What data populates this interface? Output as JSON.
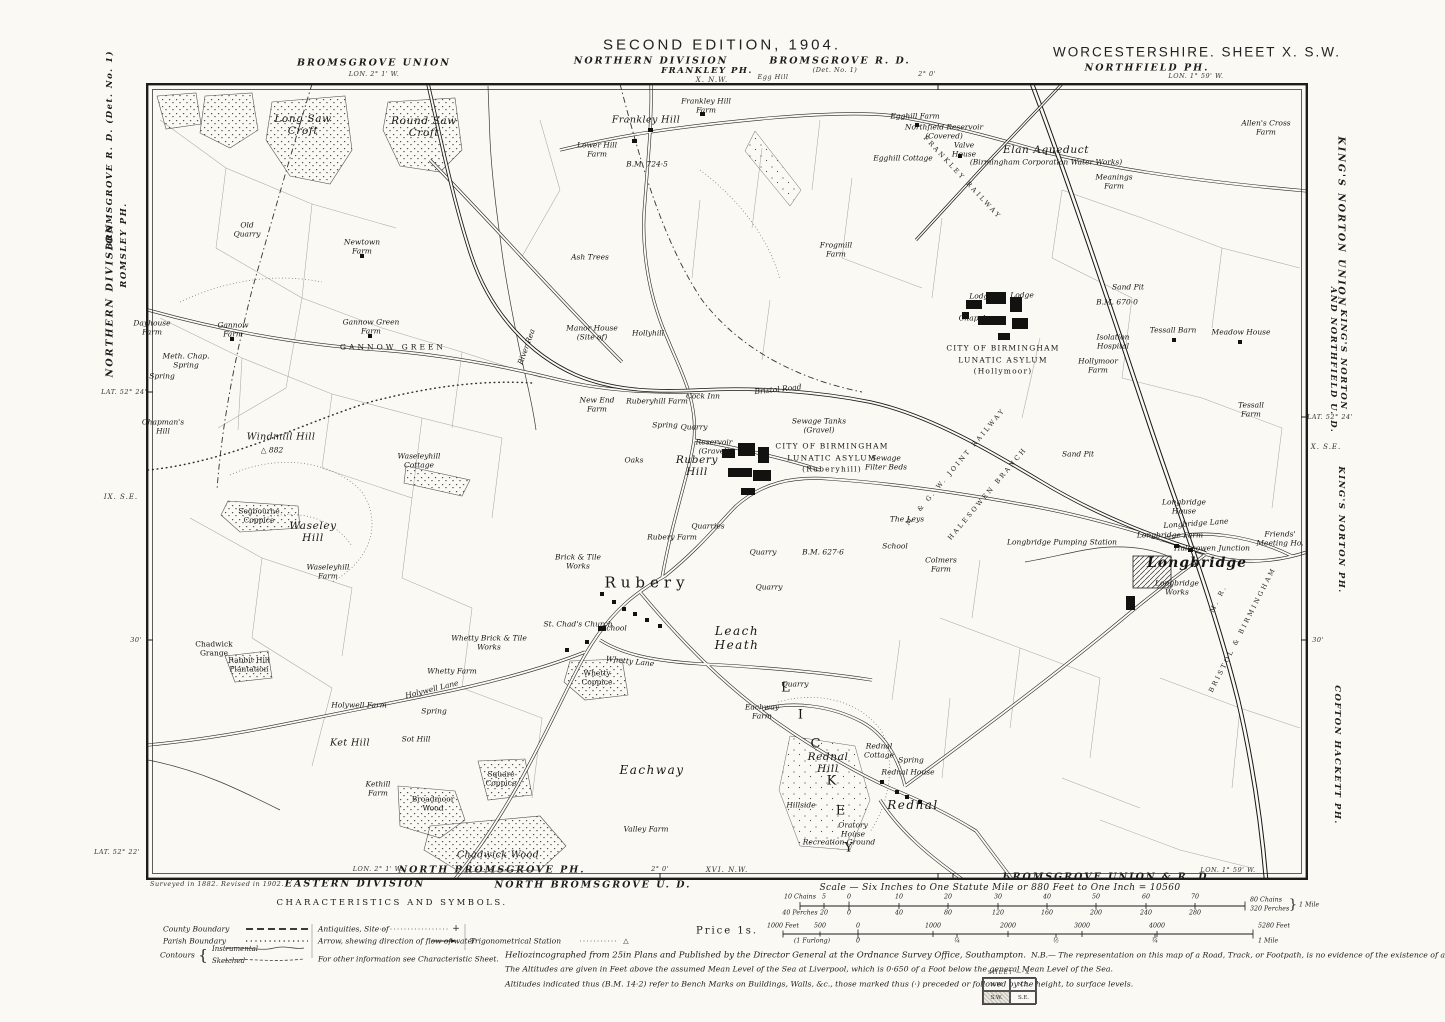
{
  "colors": {
    "paper": "#fbf9f4",
    "ink": "#1c1c1b",
    "field_lines": "#9a9a9a"
  },
  "header": {
    "union_left": "BROMSGROVE UNION",
    "lon_left": "LON. 2° 1' W.",
    "edition": "SECOND EDITION, 1904.",
    "division": "NORTHERN DIVISION",
    "frankley": "FRANKLEY PH.",
    "adjoining_top": "X. N.W.",
    "egg_hill": "Egg Hill",
    "bromsgrove_rd": "BROMSGROVE R. D.",
    "det": "(Det. No. 1)",
    "lon_tick": "2° 0'",
    "county_sheet": "WORCESTERSHIRE. SHEET X. S.W.",
    "northfield": "NORTHFIELD PH.",
    "lon_right": "LON. 1° 59' W."
  },
  "margin_left": {
    "division": "NORTHERN DIVISION",
    "romsley": "ROMSLEY PH.",
    "bromsgrove": "BROMSGROVE R. D.  (Det. No. 1)",
    "lat": "LAT. 52° 24'",
    "adjoining": "IX. S.E.",
    "tick30": "30'",
    "lat_bottom": "LAT. 52° 22'"
  },
  "margin_right": {
    "union": "KING'S NORTON UNION",
    "und": "KING'S NORTON\nAND NORTHFIELD U. D.",
    "lat": "LAT. 52° 24'",
    "adjoining": "X. S.E.",
    "tick30": "30'",
    "kings_norton_ph": "KING'S NORTON PH.",
    "cofton": "COFTON HACKETT PH."
  },
  "margin_bottom": {
    "surveyed": "Surveyed in 1882.   Revised in 1902.",
    "eastern_division": "EASTERN DIVISION",
    "lon_left": "LON. 2° 1' W.",
    "north_bromsgrove_ph": "NORTH BROMSGROVE PH.",
    "north_bromsgrove_ud": "NORTH BROMSGROVE U. D.",
    "lon_tick": "2° 0'",
    "adjoining": "XVI. N.W.",
    "bromsgrove_union_rd": "BROMSGROVE UNION & R. D.",
    "lon_right": "LON. 1° 59' W."
  },
  "legend": {
    "title": "CHARACTERISTICS AND SYMBOLS.",
    "county": "County Boundary",
    "parish": "Parish Boundary",
    "contours": "Contours",
    "brace": "{",
    "instrumental": "Instrumental",
    "sketched": "Sketched",
    "antiquities": "Antiquities, Site of",
    "antiquities_sym": "+",
    "arrow": "Arrow, shewing direction of flow of water",
    "trig": "Trigonometrical Station",
    "trig_sym": "△",
    "other_info": "For other information see Characteristic Sheet."
  },
  "scale": {
    "caption": "Scale — Six Inches to One Statute Mile or 880 Feet to One Inch = 10560",
    "price": "Price  1s.",
    "end1_top": "80 Chains",
    "end1_bottom": "320 Perches",
    "brace1": "}",
    "end1_mile": "1 Mile",
    "end2_feet": "5280 Feet",
    "end2_mile": "1 Mile",
    "ticks": [
      {
        "t": "10 Chains",
        "x": 800,
        "y": 897
      },
      {
        "t": "5",
        "x": 824,
        "y": 897
      },
      {
        "t": "0",
        "x": 849,
        "y": 897
      },
      {
        "t": "10",
        "x": 899,
        "y": 897
      },
      {
        "t": "20",
        "x": 948,
        "y": 897
      },
      {
        "t": "30",
        "x": 998,
        "y": 897
      },
      {
        "t": "40",
        "x": 1047,
        "y": 897
      },
      {
        "t": "50",
        "x": 1096,
        "y": 897
      },
      {
        "t": "60",
        "x": 1146,
        "y": 897
      },
      {
        "t": "70",
        "x": 1195,
        "y": 897
      },
      {
        "t": "40 Perches",
        "x": 800,
        "y": 913
      },
      {
        "t": "20",
        "x": 824,
        "y": 913
      },
      {
        "t": "0",
        "x": 849,
        "y": 913
      },
      {
        "t": "40",
        "x": 899,
        "y": 913
      },
      {
        "t": "80",
        "x": 948,
        "y": 913
      },
      {
        "t": "120",
        "x": 998,
        "y": 913
      },
      {
        "t": "160",
        "x": 1047,
        "y": 913
      },
      {
        "t": "200",
        "x": 1096,
        "y": 913
      },
      {
        "t": "240",
        "x": 1146,
        "y": 913
      },
      {
        "t": "280",
        "x": 1195,
        "y": 913
      },
      {
        "t": "1000 Feet",
        "x": 783,
        "y": 926
      },
      {
        "t": "500",
        "x": 820,
        "y": 926
      },
      {
        "t": "0",
        "x": 858,
        "y": 926
      },
      {
        "t": "1000",
        "x": 933,
        "y": 926
      },
      {
        "t": "2000",
        "x": 1008,
        "y": 926
      },
      {
        "t": "3000",
        "x": 1082,
        "y": 926
      },
      {
        "t": "4000",
        "x": 1157,
        "y": 926
      },
      {
        "t": "(1 Furlong)",
        "x": 812,
        "y": 941
      },
      {
        "t": "0",
        "x": 858,
        "y": 941
      },
      {
        "t": "¼",
        "x": 957,
        "y": 941
      },
      {
        "t": "½",
        "x": 1056,
        "y": 941
      },
      {
        "t": "¾",
        "x": 1155,
        "y": 941
      }
    ]
  },
  "imprint": {
    "line1": "Heliozincographed from 25in Plans and Published by the Director General at the Ordnance Survey Office, Southampton.",
    "nb": "N.B.— The representation on this map of a Road, Track, or Footpath, is no evidence of the existence of a right of way.",
    "line2": "The Altitudes are given in Feet above the assumed Mean Level of the Sea at Liverpool, which is 0·650 of a Foot below the general Mean Level of the Sea.",
    "line3": "Altitudes indicated thus (B.M. 14·2) refer to Bench Marks on Buildings, Walls, &c., those marked thus (·) preceded or followed by the height, to surface levels."
  },
  "sheet_diagram": {
    "header": "SHEET — X",
    "nw": "N.W.",
    "ne": "N.E.",
    "sw": "S.W.",
    "se": "S.E."
  },
  "map_labels": [
    {
      "t": "Long Saw\nCroft",
      "x": 303,
      "y": 125,
      "c": "h"
    },
    {
      "t": "Round Saw\nCroft",
      "x": 424,
      "y": 127,
      "c": "h"
    },
    {
      "t": "Old\nQuarry",
      "x": 247,
      "y": 230,
      "c": "t"
    },
    {
      "t": "Newtown\nFarm",
      "x": 362,
      "y": 247,
      "c": "t"
    },
    {
      "t": "Ash Trees",
      "x": 590,
      "y": 258,
      "c": "t"
    },
    {
      "t": "B.M. 724·5",
      "x": 647,
      "y": 165,
      "c": "t"
    },
    {
      "t": "Frankley Hill",
      "x": 646,
      "y": 121,
      "c": "n"
    },
    {
      "t": "Frankley Hill\nFarm",
      "x": 706,
      "y": 106,
      "c": "t"
    },
    {
      "t": "Lower Hill\nFarm",
      "x": 597,
      "y": 150,
      "c": "t"
    },
    {
      "t": "Egghill Farm",
      "x": 915,
      "y": 117,
      "c": "t"
    },
    {
      "t": "Egghill Cottage",
      "x": 903,
      "y": 159,
      "c": "t"
    },
    {
      "t": "Northfield Reservoir\n(Covered)",
      "x": 944,
      "y": 132,
      "c": "t"
    },
    {
      "t": "Valve\nHouse",
      "x": 964,
      "y": 150,
      "c": "t"
    },
    {
      "t": "Elan Aqueduct",
      "x": 1046,
      "y": 150,
      "c": "h"
    },
    {
      "t": "(Birmingham Corporation Water Works)",
      "x": 1046,
      "y": 163,
      "c": "t"
    },
    {
      "t": "Frogmill\nFarm",
      "x": 836,
      "y": 250,
      "c": "t"
    },
    {
      "t": "Meanings\nFarm",
      "x": 1114,
      "y": 182,
      "c": "t"
    },
    {
      "t": "Allen's Cross\nFarm",
      "x": 1266,
      "y": 128,
      "c": "t"
    },
    {
      "t": "FRANKLEY RAILWAY",
      "x": 962,
      "y": 178,
      "c": "rly",
      "r": 47
    },
    {
      "t": "Sand Pit",
      "x": 1128,
      "y": 288,
      "c": "t"
    },
    {
      "t": "B.M. 670·0",
      "x": 1117,
      "y": 303,
      "c": "t"
    },
    {
      "t": "Lodge",
      "x": 981,
      "y": 297,
      "c": "t"
    },
    {
      "t": "Lodge",
      "x": 1022,
      "y": 296,
      "c": "t"
    },
    {
      "t": "Chapel",
      "x": 972,
      "y": 319,
      "c": "t"
    },
    {
      "t": "CITY OF BIRMINGHAM\nLUNATIC ASYLUM\n(Hollymoor)",
      "x": 1003,
      "y": 360,
      "c": "asy"
    },
    {
      "t": "Isolation\nHospital",
      "x": 1113,
      "y": 342,
      "c": "t"
    },
    {
      "t": "Hollymoor\nFarm",
      "x": 1098,
      "y": 366,
      "c": "t"
    },
    {
      "t": "Tessall Barn",
      "x": 1173,
      "y": 331,
      "c": "t"
    },
    {
      "t": "Meadow House",
      "x": 1241,
      "y": 333,
      "c": "t"
    },
    {
      "t": "Tessall\nFarm",
      "x": 1251,
      "y": 410,
      "c": "t"
    },
    {
      "t": "Sand Pit",
      "x": 1078,
      "y": 455,
      "c": "t"
    },
    {
      "t": "Dayhouse\nFarm",
      "x": 152,
      "y": 328,
      "c": "t"
    },
    {
      "t": "Meth. Chap.\nSpring",
      "x": 186,
      "y": 361,
      "c": "t"
    },
    {
      "t": "Spring",
      "x": 162,
      "y": 377,
      "c": "t"
    },
    {
      "t": "Gannow\nFarm",
      "x": 233,
      "y": 330,
      "c": "t"
    },
    {
      "t": "Gannow Green\nFarm",
      "x": 371,
      "y": 327,
      "c": "t"
    },
    {
      "t": "GANNOW GREEN",
      "x": 393,
      "y": 348,
      "c": "cap"
    },
    {
      "t": "Chapman's\nHill",
      "x": 163,
      "y": 427,
      "c": "t"
    },
    {
      "t": "Windmill Hill",
      "x": 281,
      "y": 438,
      "c": "n"
    },
    {
      "t": "△ 882",
      "x": 272,
      "y": 451,
      "c": "t"
    },
    {
      "t": "Waseleyhill\nCottage",
      "x": 419,
      "y": 461,
      "c": "t"
    },
    {
      "t": "Segbourne\nCoppice",
      "x": 259,
      "y": 516,
      "c": "tr"
    },
    {
      "t": "Waseley\nHill",
      "x": 313,
      "y": 532,
      "c": "h"
    },
    {
      "t": "Waseleyhill\nFarm",
      "x": 328,
      "y": 572,
      "c": "t"
    },
    {
      "t": "River Rea",
      "x": 527,
      "y": 347,
      "c": "t",
      "r": -70
    },
    {
      "t": "Manor House\n(Site of)",
      "x": 592,
      "y": 333,
      "c": "t"
    },
    {
      "t": "Hollyhill",
      "x": 648,
      "y": 334,
      "c": "t"
    },
    {
      "t": "New End\nFarm",
      "x": 597,
      "y": 405,
      "c": "t"
    },
    {
      "t": "Ruberyhill Farm",
      "x": 657,
      "y": 402,
      "c": "t"
    },
    {
      "t": "Cock Inn",
      "x": 703,
      "y": 397,
      "c": "t"
    },
    {
      "t": "Spring",
      "x": 665,
      "y": 426,
      "c": "t"
    },
    {
      "t": "Quarry",
      "x": 694,
      "y": 428,
      "c": "t"
    },
    {
      "t": "Reservoir\n(Gravel)",
      "x": 714,
      "y": 447,
      "c": "t"
    },
    {
      "t": "Rubery\nHill",
      "x": 697,
      "y": 466,
      "c": "h"
    },
    {
      "t": "Oaks",
      "x": 634,
      "y": 461,
      "c": "t"
    },
    {
      "t": "Sewage Tanks\n(Gravel)",
      "x": 819,
      "y": 426,
      "c": "t"
    },
    {
      "t": "CITY OF BIRMINGHAM\nLUNATIC ASYLUM\n(Ruberyhill)",
      "x": 832,
      "y": 458,
      "c": "asy"
    },
    {
      "t": "Sewage\nFilter Beds",
      "x": 886,
      "y": 463,
      "c": "t"
    },
    {
      "t": "Bristol Road",
      "x": 778,
      "y": 390,
      "c": "t",
      "r": -6
    },
    {
      "t": "M. & G. W. JOINT RAILWAY",
      "x": 956,
      "y": 467,
      "c": "rly",
      "r": -50
    },
    {
      "t": "HALESOWEN BRANCH",
      "x": 988,
      "y": 494,
      "c": "rly",
      "r": -50
    },
    {
      "t": "Quarries",
      "x": 708,
      "y": 527,
      "c": "t"
    },
    {
      "t": "Rubery Farm",
      "x": 672,
      "y": 538,
      "c": "t"
    },
    {
      "t": "Quarry",
      "x": 763,
      "y": 553,
      "c": "t"
    },
    {
      "t": "Quarry",
      "x": 769,
      "y": 588,
      "c": "t"
    },
    {
      "t": "B.M. 627·6",
      "x": 823,
      "y": 553,
      "c": "t"
    },
    {
      "t": "Brick & Tile\nWorks",
      "x": 578,
      "y": 562,
      "c": "t"
    },
    {
      "t": "Rubery",
      "x": 647,
      "y": 583,
      "c": "vil"
    },
    {
      "t": "St. Chad's Church",
      "x": 578,
      "y": 625,
      "c": "t"
    },
    {
      "t": "The Leys",
      "x": 907,
      "y": 520,
      "c": "t"
    },
    {
      "t": "School",
      "x": 895,
      "y": 547,
      "c": "t"
    },
    {
      "t": "Colmers\nFarm",
      "x": 941,
      "y": 565,
      "c": "t"
    },
    {
      "t": "Longbridge Pumping Station",
      "x": 1062,
      "y": 543,
      "c": "t"
    },
    {
      "t": "Halesowen Junction",
      "x": 1212,
      "y": 549,
      "c": "t"
    },
    {
      "t": "Longbridge\nHouse",
      "x": 1184,
      "y": 507,
      "c": "t"
    },
    {
      "t": "Longbridge Lane",
      "x": 1196,
      "y": 524,
      "c": "t",
      "r": -4
    },
    {
      "t": "Longbridge Farm",
      "x": 1170,
      "y": 536,
      "c": "t"
    },
    {
      "t": "Longbridge",
      "x": 1197,
      "y": 563,
      "c": "vb"
    },
    {
      "t": "Longbridge\nWorks",
      "x": 1177,
      "y": 588,
      "c": "t"
    },
    {
      "t": "Friends'\nMeeting Ho.",
      "x": 1280,
      "y": 539,
      "c": "t"
    },
    {
      "t": "M. R.",
      "x": 1219,
      "y": 599,
      "c": "rly",
      "r": -63
    },
    {
      "t": "BRISTOL & BIRMINGHAM",
      "x": 1243,
      "y": 630,
      "c": "rly",
      "r": -63
    },
    {
      "t": "Whetty Brick & Tile\nWorks",
      "x": 489,
      "y": 643,
      "c": "t"
    },
    {
      "t": "Whetty Farm",
      "x": 452,
      "y": 672,
      "c": "t"
    },
    {
      "t": "Whetty Lane",
      "x": 630,
      "y": 662,
      "c": "t",
      "r": 6
    },
    {
      "t": "School",
      "x": 614,
      "y": 629,
      "c": "t"
    },
    {
      "t": "Whetty\nCoppice",
      "x": 597,
      "y": 678,
      "c": "tr"
    },
    {
      "t": "Leach\nHeath",
      "x": 737,
      "y": 639,
      "c": "vi"
    },
    {
      "t": "Holywell Farm",
      "x": 359,
      "y": 706,
      "c": "t"
    },
    {
      "t": "Holywell Lane",
      "x": 432,
      "y": 690,
      "c": "t",
      "r": -14
    },
    {
      "t": "Spring",
      "x": 434,
      "y": 712,
      "c": "t"
    },
    {
      "t": "Ket Hill",
      "x": 350,
      "y": 744,
      "c": "n"
    },
    {
      "t": "Sot Hill",
      "x": 416,
      "y": 740,
      "c": "t"
    },
    {
      "t": "Kethill\nFarm",
      "x": 378,
      "y": 789,
      "c": "t"
    },
    {
      "t": "Broadmoor\nWood",
      "x": 433,
      "y": 804,
      "c": "tr"
    },
    {
      "t": "Square\nCoppice",
      "x": 501,
      "y": 779,
      "c": "tr"
    },
    {
      "t": "Eachway",
      "x": 652,
      "y": 771,
      "c": "vi"
    },
    {
      "t": "Eachway\nFarm",
      "x": 762,
      "y": 712,
      "c": "t"
    },
    {
      "t": "Valley Farm",
      "x": 646,
      "y": 830,
      "c": "t"
    },
    {
      "t": "Chadwick Wood",
      "x": 498,
      "y": 856,
      "c": "n"
    },
    {
      "t": "Chadwick\nGrange",
      "x": 214,
      "y": 649,
      "c": "tr"
    },
    {
      "t": "Rabbit Hill\nPlantation",
      "x": 249,
      "y": 665,
      "c": "tr"
    },
    {
      "t": "Quarry",
      "x": 795,
      "y": 685,
      "c": "t"
    },
    {
      "t": "Rednal\nHill",
      "x": 828,
      "y": 763,
      "c": "h"
    },
    {
      "t": "Hillside",
      "x": 801,
      "y": 806,
      "c": "t"
    },
    {
      "t": "Rednal\nCottage",
      "x": 879,
      "y": 751,
      "c": "t"
    },
    {
      "t": "Spring",
      "x": 911,
      "y": 761,
      "c": "t"
    },
    {
      "t": "Rednal House",
      "x": 908,
      "y": 773,
      "c": "t"
    },
    {
      "t": "Rednal",
      "x": 913,
      "y": 806,
      "c": "vi"
    },
    {
      "t": "Oratory\nHouse",
      "x": 853,
      "y": 830,
      "c": "t"
    },
    {
      "t": "Recreation Ground",
      "x": 839,
      "y": 843,
      "c": "t"
    },
    {
      "t": "L",
      "x": 786,
      "y": 689,
      "c": "dist"
    },
    {
      "t": "I",
      "x": 801,
      "y": 716,
      "c": "dist"
    },
    {
      "t": "C",
      "x": 816,
      "y": 745,
      "c": "dist"
    },
    {
      "t": "K",
      "x": 832,
      "y": 782,
      "c": "dist"
    },
    {
      "t": "E",
      "x": 841,
      "y": 812,
      "c": "dist"
    },
    {
      "t": "Y",
      "x": 849,
      "y": 849,
      "c": "dist"
    }
  ]
}
